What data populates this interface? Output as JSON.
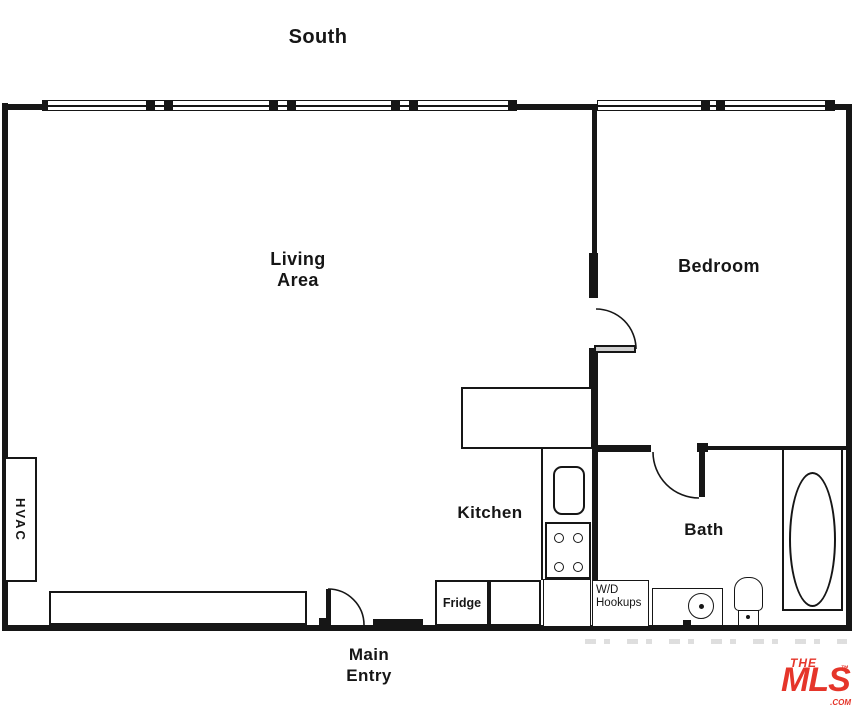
{
  "colors": {
    "ink": "#161616",
    "logo-red": "#E5352A",
    "watermark": "#c4c4c4"
  },
  "compass": {
    "south": "South"
  },
  "rooms": {
    "living": {
      "line1": "Living",
      "line2": "Area"
    },
    "bedroom": {
      "label": "Bedroom"
    },
    "kitchen": {
      "label": "Kitchen"
    },
    "bath": {
      "label": "Bath"
    }
  },
  "fixtures": {
    "hvac": {
      "label": "HVAC"
    },
    "fridge": {
      "label": "Fridge"
    },
    "washer_dryer": {
      "line1": "W/D",
      "line2": "Hookups"
    }
  },
  "entry": {
    "line1": "Main",
    "line2": "Entry"
  },
  "logo": {
    "the": "THE",
    "mls": "MLS",
    "trademark": "™",
    "com": ".COM"
  }
}
